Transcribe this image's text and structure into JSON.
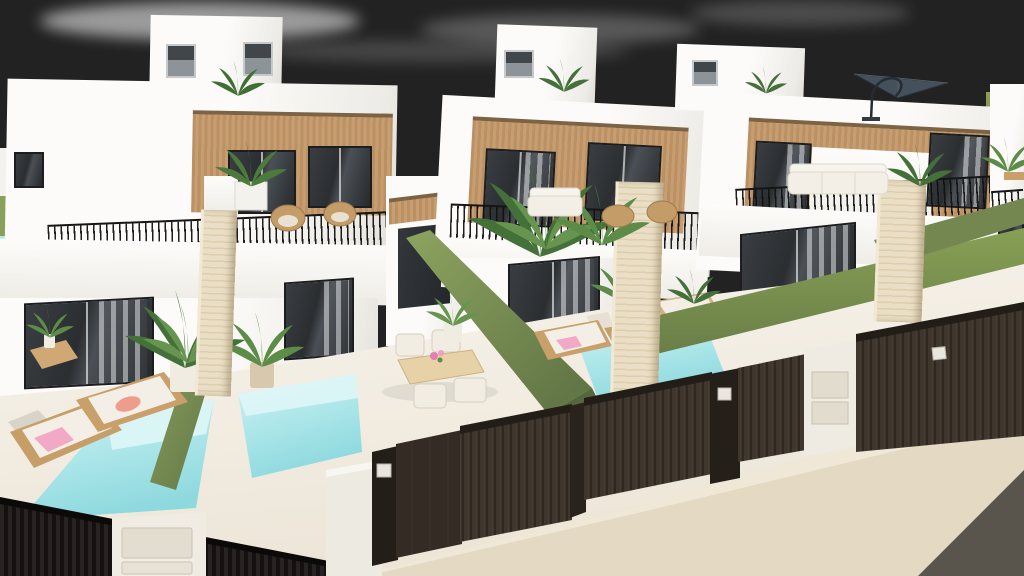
{
  "meta": {
    "caption": "3D exterior render of a row of modern white two-storey villas with wood-clad balconies, private turquoise plunge pools, green hedge divider walls and dark slatted street fences under a hazy blue sky"
  },
  "colors": {
    "sky_left": "#c9d1d6",
    "sky_mid": "#93a5b4",
    "sky_right": "#5e7286",
    "cloud": "#ffffff",
    "field_green": "#8e9c55",
    "wall_white": "#fbfaf7",
    "wall_shade": "#e2dfd8",
    "wood": "#c89e70",
    "wood_dark": "#ba9164",
    "glass": "#2b2e31",
    "window_frame": "#1b1d1f",
    "railing": "#151515",
    "green_wall": "#7d9156",
    "green_wall_dark": "#5d7143",
    "pool_light": "#d8f3f4",
    "pool_deep": "#8ed9de",
    "terrace": "#f1ebe0",
    "travertine": "#eadfc6",
    "fence_black": "#151110",
    "fence_espresso": "#2f2822",
    "gate_panel": "#332b24",
    "plate_white": "#e9e6df",
    "sidewalk": "#e4dac4",
    "road": "#59544c",
    "towel_pink": "#f2a9c6",
    "towel_coral": "#ef9d8b",
    "rattan": "#c49c68",
    "cushion_white": "#f3efe6",
    "plant_dark": "#44703a",
    "plant_light": "#679550",
    "parasol": "#44505b"
  },
  "scene": {
    "villas_visible": 4,
    "pools_visible": 3,
    "objects": [
      "white-villa",
      "roof-stair-bulkhead",
      "wood-clad-balcony",
      "black-slat-railing",
      "travertine-chimney",
      "private-plunge-pool",
      "green-hedge-wall",
      "espresso-slat-fence",
      "entrance-gate",
      "utility-meter-pillar",
      "sun-lounger",
      "pink-towel",
      "dining-set",
      "rattan-chair",
      "palm-plant",
      "cantilever-parasol",
      "sidewalk",
      "road"
    ]
  }
}
